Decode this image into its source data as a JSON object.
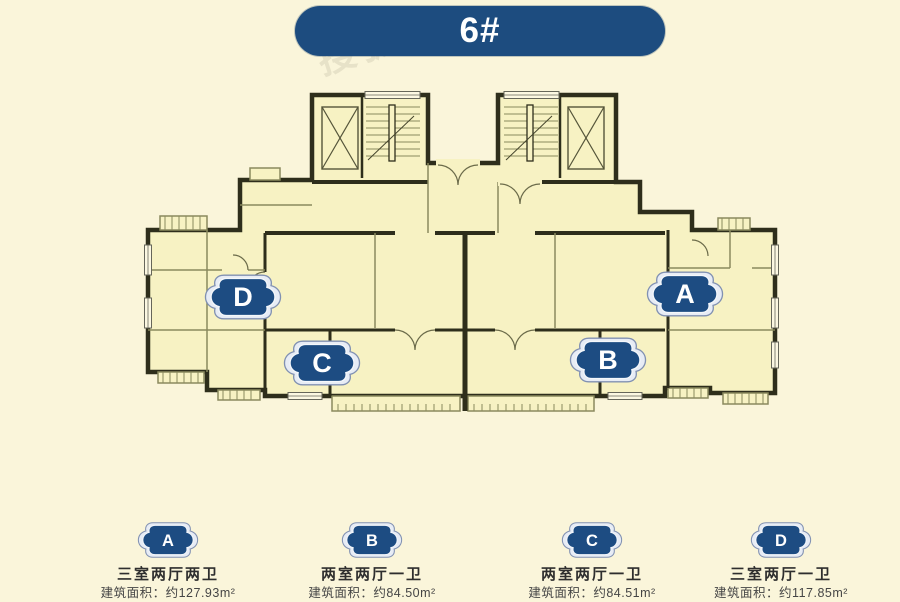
{
  "page": {
    "background_color": "#faf5da",
    "watermark_text": "搜狐"
  },
  "banner": {
    "label": "6#",
    "background_color": "#1d4c7f",
    "text_color": "#ffffff"
  },
  "floor_plan": {
    "room_fill_color": "#f7f2c3",
    "wall_color": "#2e2e1b",
    "badge_fill_color": "#1d4c82",
    "badge_ring_color": "#e7ecf5",
    "unit_badges": [
      {
        "label": "A"
      },
      {
        "label": "B"
      },
      {
        "label": "C"
      },
      {
        "label": "D"
      }
    ]
  },
  "legend": {
    "items": [
      {
        "label": "A",
        "type": "三室两厅两卫",
        "area": "建筑面积：约127.93m²"
      },
      {
        "label": "B",
        "type": "两室两厅一卫",
        "area": "建筑面积：约84.50m²"
      },
      {
        "label": "C",
        "type": "两室两厅一卫",
        "area": "建筑面积：约84.51m²"
      },
      {
        "label": "D",
        "type": "三室两厅一卫",
        "area": "建筑面积：约117.85m²"
      }
    ]
  }
}
